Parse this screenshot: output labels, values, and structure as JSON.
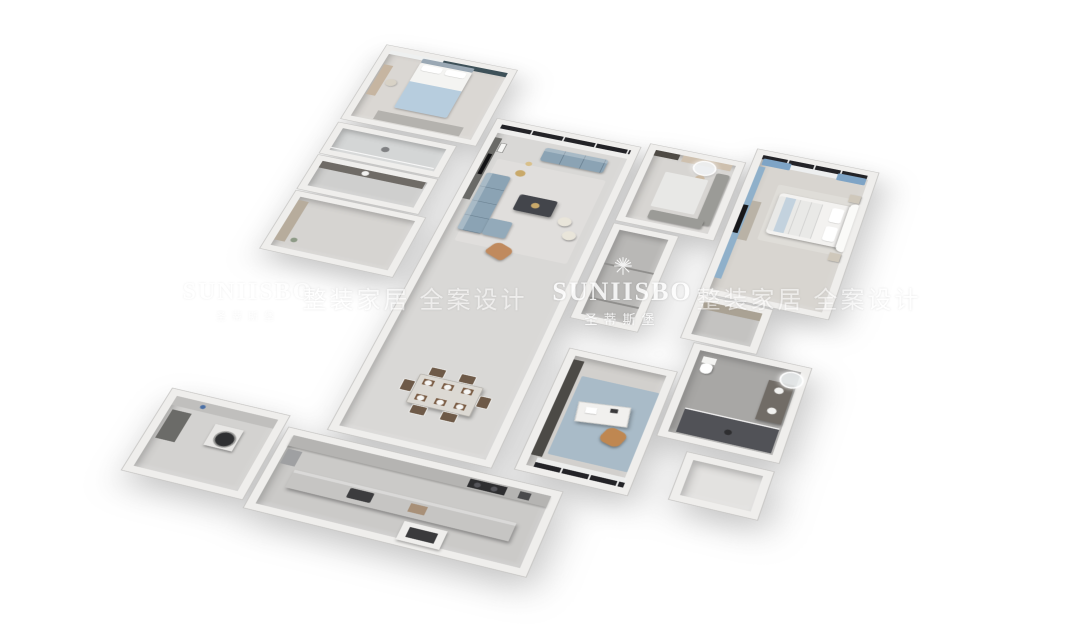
{
  "watermarks": {
    "left": {
      "brand": "SUNIISBO",
      "brand_zh": "圣蒂斯堡"
    },
    "center": {
      "brand": "SUNIISBO",
      "brand_zh": "圣蒂斯堡"
    },
    "slogan_left": "整装家居 全案设计",
    "slogan_right": "整装家居 全案设计"
  },
  "scene": {
    "type": "3d-isometric-floor-plan-render",
    "background": "#ffffff",
    "rooms": [
      {
        "id": "bedroom-2",
        "key_items": [
          "bed-blue-bedding",
          "teal-curtains",
          "vanity-desk",
          "wardrobe"
        ]
      },
      {
        "id": "ensuite-shower",
        "key_items": [
          "shower"
        ]
      },
      {
        "id": "ensuite-vanity",
        "key_items": [
          "vanity-counter",
          "basin"
        ]
      },
      {
        "id": "entry-hall",
        "key_items": [
          "shoe-cabinet"
        ]
      },
      {
        "id": "living-dining-great-room",
        "key_items": [
          "black-framed-window",
          "sheer-curtains",
          "tv-wall",
          "blue-l-sofa",
          "blue-loveseat",
          "marble-coffee-table",
          "cream-poufs",
          "tan-armchair",
          "gold-side-table",
          "dining-table-six-chairs"
        ]
      },
      {
        "id": "kitchen",
        "key_items": [
          "wall-counter",
          "cooktop",
          "island-counter",
          "sink",
          "oven-cabinet",
          "fridge"
        ]
      },
      {
        "id": "laundry-utility",
        "key_items": [
          "washing-machine",
          "counter",
          "dark-cabinet"
        ]
      },
      {
        "id": "dressing-room",
        "key_items": [
          "round-lit-mirror",
          "vanity-counter",
          "mirror-wardrobe",
          "grey-lounge",
          "marble-rug",
          "stool"
        ]
      },
      {
        "id": "corridor",
        "key_items": [
          "dark-floor"
        ]
      },
      {
        "id": "master-bedroom",
        "key_items": [
          "blue-curtains",
          "black-framed-window",
          "white-bed-curved-headboard",
          "blue-accent-wall",
          "tv-console",
          "nightstands"
        ]
      },
      {
        "id": "wardrobe-hall",
        "key_items": [
          "sliding-wardrobe"
        ]
      },
      {
        "id": "master-bathroom",
        "key_items": [
          "toilet",
          "vanity-round-mirror",
          "dark-tile-shower",
          "glass-partition"
        ]
      },
      {
        "id": "study",
        "key_items": [
          "bookshelf",
          "white-desk",
          "tan-leather-chair",
          "blue-pattern-rug",
          "window-sheer"
        ]
      },
      {
        "id": "bay",
        "key_items": []
      }
    ]
  },
  "colors": {
    "wall": "#efeeec",
    "floor_light": "#d8d7d5",
    "floor_dark": "#b9b8b6",
    "sofa_blue": "#8ba3b4",
    "bed_blue": "#b7cdde",
    "curtain_teal": "#3e5159",
    "curtain_blue": "#7ea4c6",
    "window_frame": "#232327",
    "marble_table": "#43454b",
    "tan_leather": "#bf8751",
    "shower_tile": "#515257",
    "rug_blue": "#a9bbc8",
    "gold_accent": "#c9a96a",
    "watermark": "#ffffff"
  }
}
